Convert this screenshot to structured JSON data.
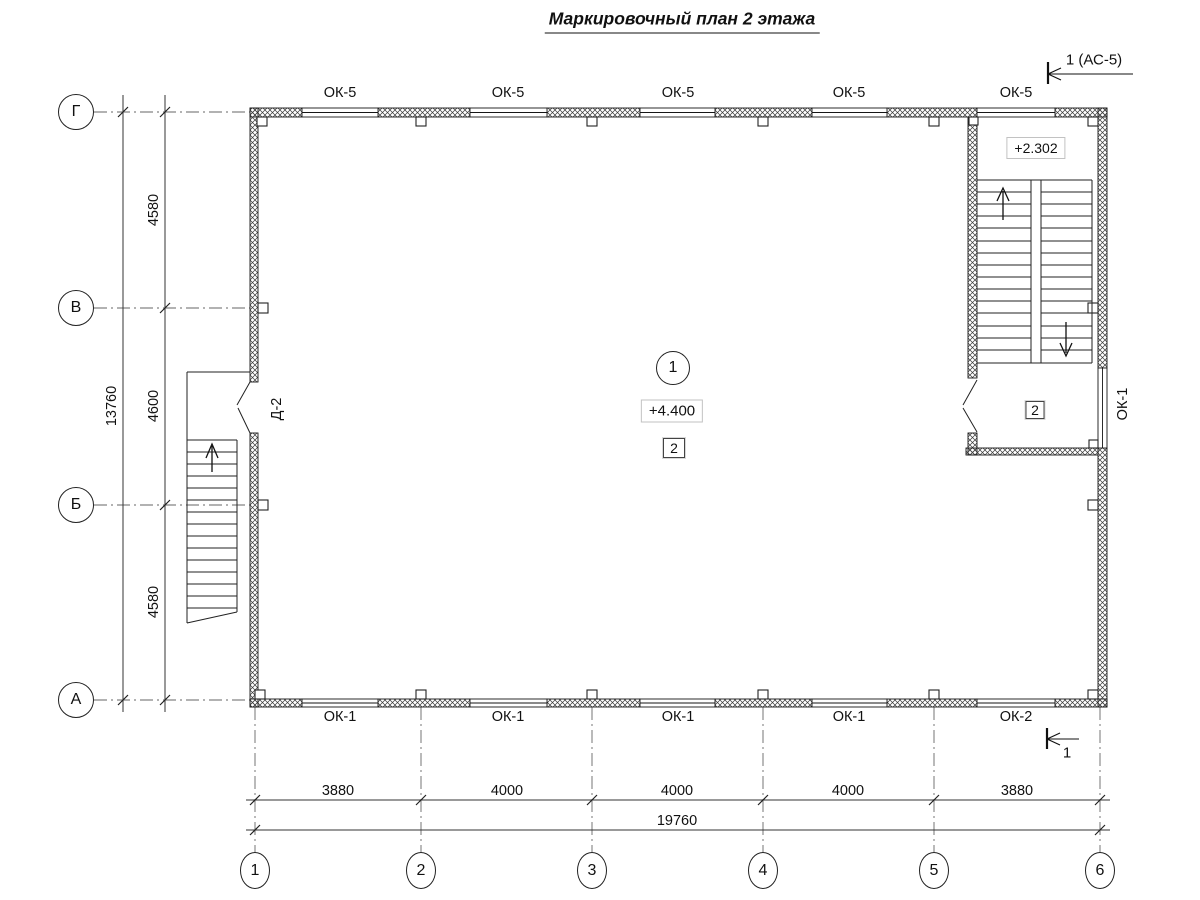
{
  "title": "Маркировочный план 2 этажа",
  "section_marks": {
    "top": "1 (АС-5)",
    "bottom": "1"
  },
  "grid": {
    "rows": [
      "Г",
      "В",
      "Б",
      "А"
    ],
    "cols": [
      "1",
      "2",
      "3",
      "4",
      "5",
      "6"
    ]
  },
  "dimensions": {
    "left": {
      "segments": [
        "4580",
        "4600",
        "4580"
      ],
      "total": "13760"
    },
    "bottom": {
      "segments": [
        "3880",
        "4000",
        "4000",
        "4000",
        "3880"
      ],
      "total": "19760"
    }
  },
  "openings": {
    "top_windows": [
      "ОК-5",
      "ОК-5",
      "ОК-5",
      "ОК-5",
      "ОК-5"
    ],
    "bottom_windows": [
      "ОК-1",
      "ОК-1",
      "ОК-1",
      "ОК-1",
      "ОК-2"
    ],
    "right_window": "ОК-1",
    "door": "Д-2"
  },
  "marks": {
    "room_number": "1",
    "room_level": "+4.400",
    "room_finish": "2",
    "stair_level": "+2.302",
    "stair_finish": "2"
  }
}
